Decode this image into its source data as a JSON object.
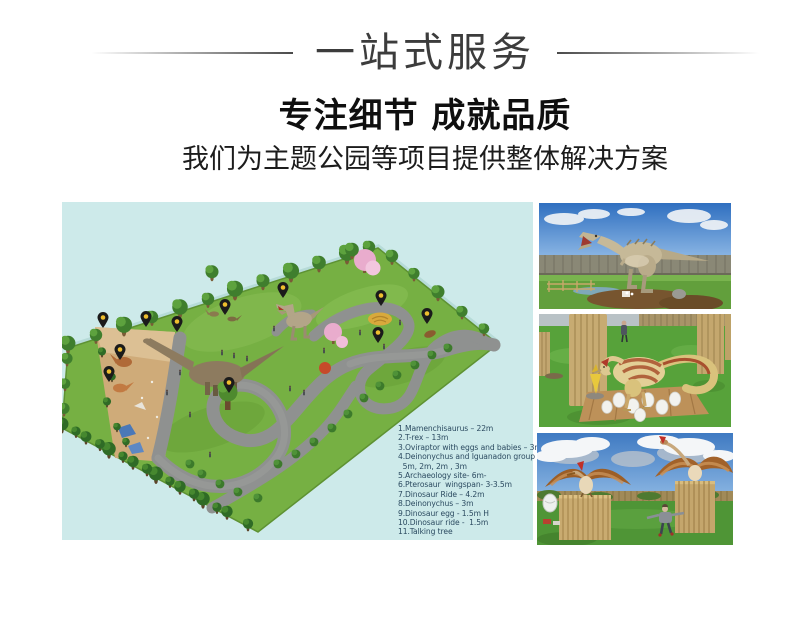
{
  "header": {
    "banner_title": "一站式服务",
    "heading": "专注细节 成就品质",
    "subheading": "我们为主题公园等项目提供整体解决方案"
  },
  "park_map": {
    "background": "#cdeaea",
    "legend_text_color": "#2b4a60",
    "legend_lines": [
      "1.Mamenchisaurus – 22m",
      "2.T-rex – 13m",
      "3.Oviraptor with eggs and babies – 3m",
      "4.Deinonychus and Iguanadon group",
      "  5m, 2m, 2m , 3m",
      "5.Archaeology site- 6m-",
      "6.Pterosaur  wingspan- 3-3.5m",
      "7.Dinosaur Ride – 4.2m",
      "8.Deinonychus – 3m",
      "9.Dinosaur egg - 1.5m H",
      "10.Dinosaur ride -  1.5m",
      "11.Talking tree"
    ],
    "pin_color": "#1b1b1b",
    "pin_dot_color": "#eebe2e",
    "pins": [
      {
        "n": 1,
        "x": 41,
        "y": 126
      },
      {
        "n": 2,
        "x": 84,
        "y": 125
      },
      {
        "n": 3,
        "x": 115,
        "y": 130
      },
      {
        "n": 4,
        "x": 58,
        "y": 158
      },
      {
        "n": 5,
        "x": 47,
        "y": 180
      },
      {
        "n": 6,
        "x": 163,
        "y": 113
      },
      {
        "n": 7,
        "x": 221,
        "y": 96
      },
      {
        "n": 8,
        "x": 167,
        "y": 191
      },
      {
        "n": 9,
        "x": 319,
        "y": 104
      },
      {
        "n": 10,
        "x": 365,
        "y": 122
      },
      {
        "n": 11,
        "x": 316,
        "y": 141
      }
    ]
  },
  "photos": [
    {
      "name": "trex-animatronic"
    },
    {
      "name": "oviraptor-with-eggs"
    },
    {
      "name": "pterosaurs-on-perches"
    }
  ]
}
